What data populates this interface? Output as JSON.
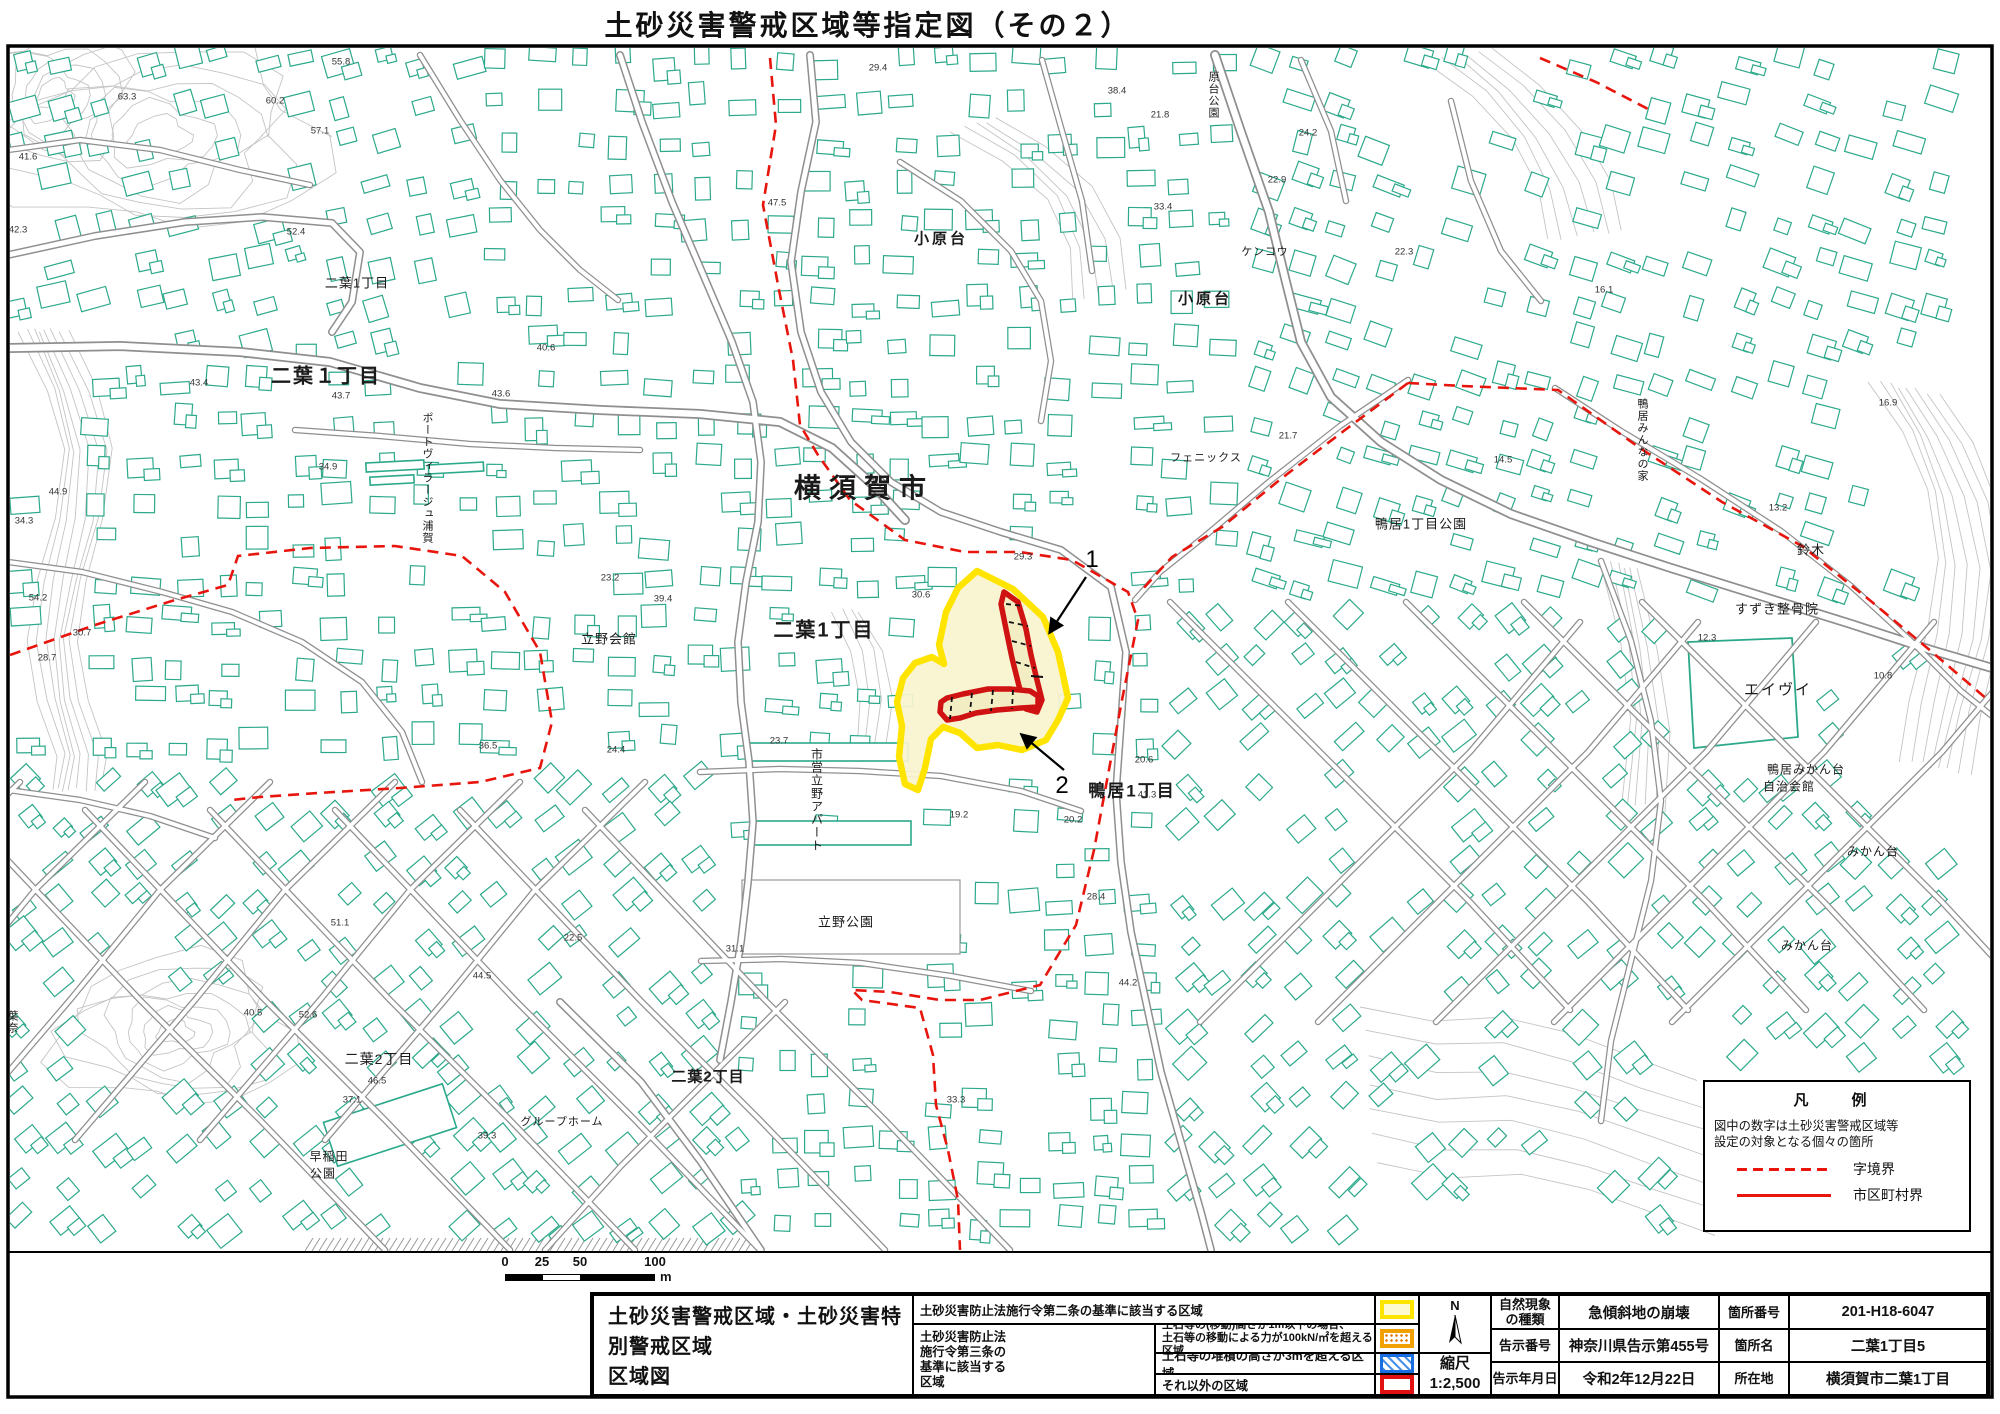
{
  "title": "土砂災害警戒区域等指定図（その２）",
  "colors": {
    "building": "#2ca98b",
    "road_casing": "#8f8f8f",
    "contour": "#c4c4c4",
    "boundary_red": "#e8150d",
    "warn_yellow_stroke": "#ffe400",
    "warn_yellow_fill": "#f8f4cf",
    "special_red_stroke": "#cf1212",
    "special_red_fill": "#f3edc4"
  },
  "map_legend_box": {
    "title": "凡　例",
    "note1": "図中の数字は土砂災害警戒区域等",
    "note2": "設定の対象となる個々の箇所",
    "dashed_label": "字境界",
    "solid_label": "市区町村界"
  },
  "scalebar": {
    "n0": "0",
    "n25": "25",
    "n50": "50",
    "n100": "100",
    "unit": "m"
  },
  "bottom": {
    "doc_title_l1": "土砂災害警戒区域・土砂災害特別警戒区域",
    "doc_title_l2": "区域図",
    "legend": {
      "row1_desc": "土砂災害防止法施行令第二条の基準に該当する区域",
      "group_label": "土砂災害防止法\n施行令第三条の\n基準に該当する\n区域",
      "row2_desc": "土石等の(移動)高さが1m以下の場合、\n土石等の移動による力が100kN/㎡を超える区域",
      "row3_desc": "土石等の堆積の高さが3mを超える区域",
      "row4_desc": "それ以外の区域"
    },
    "north_label": "N",
    "scale_label": "縮尺",
    "scale_value": "1:2,500",
    "info_rows": [
      {
        "l1": "自然現象\nの種類",
        "v1": "急傾斜地の崩壊",
        "l2": "箇所番号",
        "v2": "201-H18-6047"
      },
      {
        "l1": "告示番号",
        "v1": "神奈川県告示第455号",
        "l2": "箇所名",
        "v2": "二葉1丁目5"
      },
      {
        "l1": "告示年月日",
        "v1": "令和2年12月22日",
        "l2": "所在地",
        "v2": "横須賀市二葉1丁目"
      }
    ]
  },
  "labels": [
    {
      "t": "横須賀市",
      "x": 864,
      "y": 486,
      "s": 27,
      "w": 700,
      "ls": 8
    },
    {
      "t": "二葉1丁目",
      "x": 824,
      "y": 628,
      "s": 20,
      "w": 700,
      "ls": 2
    },
    {
      "t": "二葉１丁目",
      "x": 326,
      "y": 374,
      "s": 20,
      "w": 700,
      "ls": 2
    },
    {
      "t": "二葉1丁目",
      "x": 357,
      "y": 282,
      "s": 13
    },
    {
      "t": "小原台",
      "x": 941,
      "y": 238,
      "s": 15,
      "w": 600,
      "ls": 3
    },
    {
      "t": "小原台",
      "x": 1205,
      "y": 298,
      "s": 15,
      "w": 600,
      "ls": 3
    },
    {
      "t": "原台公園",
      "x": 1213,
      "y": 95,
      "s": 11,
      "v": 1
    },
    {
      "t": "ケンコウ",
      "x": 1265,
      "y": 251,
      "s": 11
    },
    {
      "t": "鴨居1丁目公園",
      "x": 1421,
      "y": 523,
      "s": 13
    },
    {
      "t": "フェニックス",
      "x": 1206,
      "y": 457,
      "s": 11
    },
    {
      "t": "鴨居みんなの家",
      "x": 1642,
      "y": 440,
      "s": 11,
      "v": 1
    },
    {
      "t": "鈴木",
      "x": 1811,
      "y": 549,
      "s": 13
    },
    {
      "t": "すずき整骨院",
      "x": 1777,
      "y": 608,
      "s": 13
    },
    {
      "t": "エイヴイ",
      "x": 1778,
      "y": 689,
      "s": 15,
      "ls": 2
    },
    {
      "t": "鴨居みかん台",
      "x": 1806,
      "y": 769,
      "s": 12
    },
    {
      "t": "自治会館",
      "x": 1789,
      "y": 786,
      "s": 12
    },
    {
      "t": "みかん台",
      "x": 1873,
      "y": 851,
      "s": 12
    },
    {
      "t": "みかん台",
      "x": 1807,
      "y": 945,
      "s": 12
    },
    {
      "t": "鴨居1丁目",
      "x": 1132,
      "y": 789,
      "s": 17,
      "w": 700,
      "ls": 2
    },
    {
      "t": "立野会館",
      "x": 609,
      "y": 638,
      "s": 13
    },
    {
      "t": "市営立野アパート",
      "x": 817,
      "y": 800,
      "s": 12,
      "v": 1
    },
    {
      "t": "立野公園",
      "x": 846,
      "y": 921,
      "s": 13
    },
    {
      "t": "二葉2丁目",
      "x": 379,
      "y": 1059,
      "s": 14
    },
    {
      "t": "二葉2丁目",
      "x": 708,
      "y": 1076,
      "s": 15,
      "w": 600
    },
    {
      "t": "グループホーム",
      "x": 562,
      "y": 1121,
      "s": 11
    },
    {
      "t": "早稲田",
      "x": 329,
      "y": 1156,
      "s": 12
    },
    {
      "t": "公園",
      "x": 323,
      "y": 1173,
      "s": 12
    },
    {
      "t": "葉奈",
      "x": 12,
      "y": 1022,
      "s": 11,
      "v": 1
    },
    {
      "t": "ポートヴィラージュ浦賀",
      "x": 427,
      "y": 478,
      "s": 11,
      "v": 1
    }
  ],
  "elevations": [
    [
      "55.8",
      341,
      62
    ],
    [
      "63.3",
      127,
      97
    ],
    [
      "60.2",
      275,
      101
    ],
    [
      "57.1",
      320,
      131
    ],
    [
      "41.6",
      28,
      157
    ],
    [
      "42.3",
      18,
      230
    ],
    [
      "52.4",
      296,
      232
    ],
    [
      "29.4",
      878,
      68
    ],
    [
      "47.5",
      777,
      203
    ],
    [
      "38.4",
      1117,
      91
    ],
    [
      "21.8",
      1160,
      115
    ],
    [
      "24.2",
      1308,
      133
    ],
    [
      "22.9",
      1277,
      180
    ],
    [
      "33.4",
      1163,
      207
    ],
    [
      "22.3",
      1404,
      252
    ],
    [
      "16.1",
      1604,
      290
    ],
    [
      "43.4",
      199,
      383
    ],
    [
      "43.7",
      341,
      396
    ],
    [
      "43.6",
      501,
      394
    ],
    [
      "40.6",
      546,
      348
    ],
    [
      "34.9",
      328,
      467
    ],
    [
      "44.9",
      58,
      492
    ],
    [
      "34.3",
      24,
      521
    ],
    [
      "54.2",
      38,
      598
    ],
    [
      "30.7",
      82,
      633
    ],
    [
      "28.7",
      47,
      658
    ],
    [
      "29.3",
      1023,
      557
    ],
    [
      "30.6",
      921,
      595
    ],
    [
      "23.2",
      610,
      578
    ],
    [
      "39.4",
      663,
      599
    ],
    [
      "21.7",
      1288,
      436
    ],
    [
      "14.5",
      1503,
      460
    ],
    [
      "13.2",
      1778,
      508
    ],
    [
      "16.9",
      1888,
      403
    ],
    [
      "12.3",
      1707,
      638
    ],
    [
      "10.8",
      1883,
      676
    ],
    [
      "24.4",
      616,
      750
    ],
    [
      "23.7",
      779,
      741
    ],
    [
      "20.6",
      1144,
      760
    ],
    [
      "19.2",
      959,
      815
    ],
    [
      "20.2",
      1073,
      820
    ],
    [
      "41.3",
      1147,
      795
    ],
    [
      "28.4",
      1096,
      897
    ],
    [
      "36.5",
      488,
      746
    ],
    [
      "22.5",
      573,
      938
    ],
    [
      "31.1",
      735,
      949
    ],
    [
      "51.1",
      340,
      923
    ],
    [
      "44.5",
      482,
      976
    ],
    [
      "40.5",
      253,
      1013
    ],
    [
      "52.6",
      308,
      1015
    ],
    [
      "46.5",
      377,
      1081
    ],
    [
      "37.1",
      352,
      1100
    ],
    [
      "39.3",
      487,
      1136
    ],
    [
      "33.3",
      956,
      1100
    ],
    [
      "44.2",
      1128,
      983
    ]
  ],
  "callouts": [
    {
      "num": "1",
      "x": 1092,
      "y": 560,
      "x1": 1086,
      "y1": 577,
      "x2": 1050,
      "y2": 632
    },
    {
      "num": "2",
      "x": 1062,
      "y": 786,
      "x1": 1064,
      "y1": 770,
      "x2": 1022,
      "y2": 735
    }
  ]
}
